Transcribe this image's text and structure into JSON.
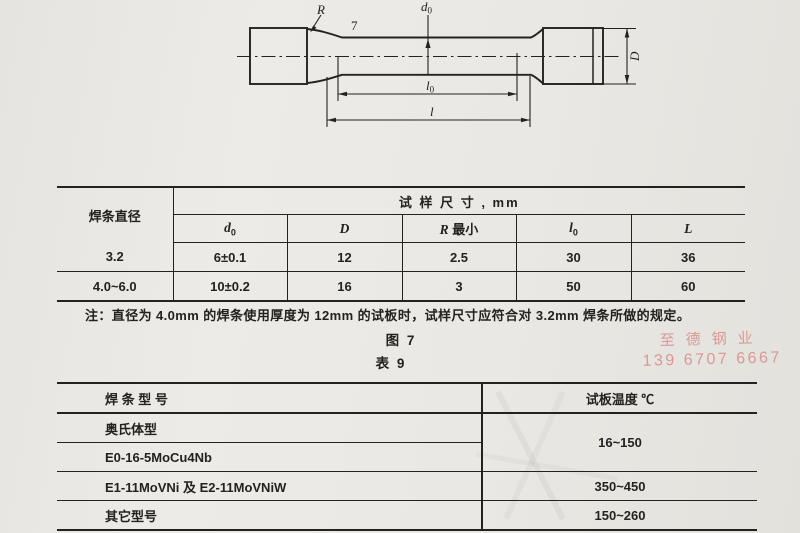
{
  "page": {
    "bg": "#eae8e4",
    "ink": "#232220"
  },
  "drawing": {
    "labels": {
      "radius": "R",
      "top_number": "7",
      "d0_sym": "d",
      "d0_sub": "0",
      "grip_diameter": "D",
      "l0_sym": "l",
      "l0_sub": "0",
      "total_length": "l"
    }
  },
  "table1": {
    "corner_header": "焊条直径",
    "span_header": "试  样  尺  寸 , mm",
    "sub_headers": [
      {
        "sym": "d",
        "sub": "0"
      },
      {
        "sym": "D"
      },
      {
        "sym": "R",
        "suffix": " 最小"
      },
      {
        "sym": "l",
        "sub": "0"
      },
      {
        "sym": "L"
      }
    ],
    "rows": [
      [
        "3.2",
        "6±0.1",
        "12",
        "2.5",
        "30",
        "36"
      ],
      [
        "4.0~6.0",
        "10±0.2",
        "16",
        "3",
        "50",
        "60"
      ]
    ]
  },
  "note": "注：直径为 4.0mm 的焊条使用厚度为 12mm 的试板时，试样尺寸应符合对 3.2mm 焊条所做的规定。",
  "figure_caption": "图 7",
  "table_caption": "表 9",
  "table2": {
    "header_model": "焊  条  型  号",
    "header_temp": "试板温度  ℃",
    "merged_temp": "16~150",
    "rows": [
      {
        "model": "奥氏体型"
      },
      {
        "model": "E0-16-5MoCu4Nb"
      },
      {
        "model": "E1-11MoVNi 及 E2-11MoVNiW",
        "temp": "350~450"
      },
      {
        "model": "其它型号",
        "temp": "150~260"
      }
    ]
  },
  "watermark": {
    "line1": "至德钢业",
    "line2": "139 6707 6667",
    "color": "#d98a8a"
  }
}
